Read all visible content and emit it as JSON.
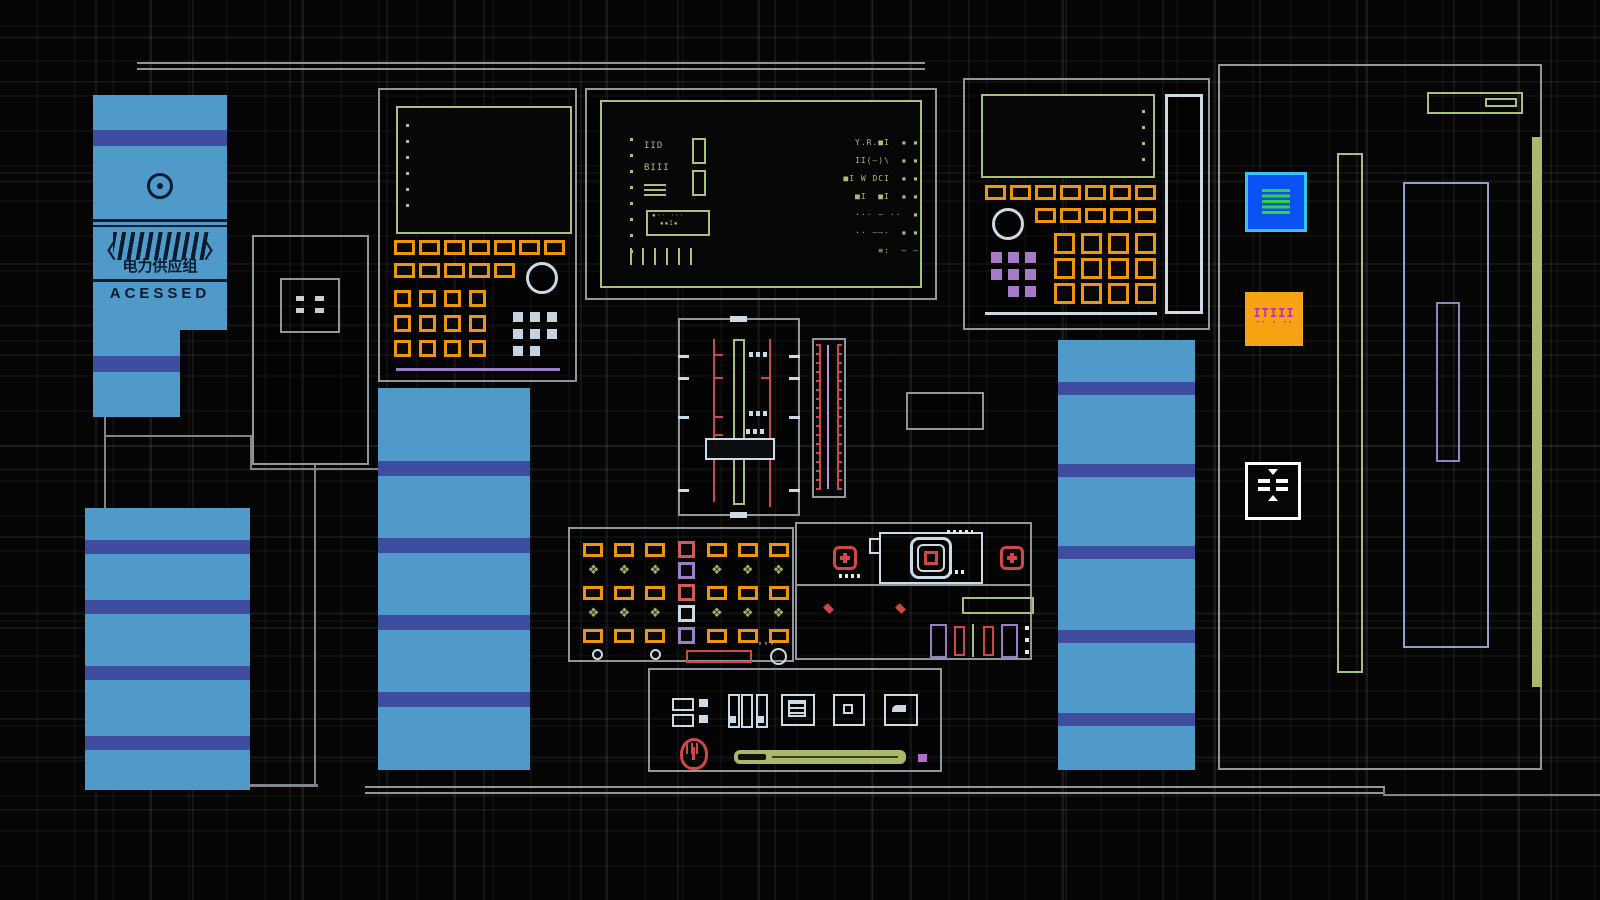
{
  "title": "power-grid-control-board",
  "colors": {
    "orange": "#ef940e",
    "screen_green": "#a9bf7a",
    "panel_blue": "#4f9ac9",
    "stripe_indigo": "#3f4da0",
    "alert_red": "#cf4747",
    "steel": "#ccdae6",
    "lavender": "#9b7fc4",
    "periwinkle": "#8fa0cc",
    "sage": "#a9b86a",
    "bright_blue": "#0b52f5",
    "cyan_border": "#35c5f2",
    "item_orange": "#f6a313",
    "magenta": "#cc22cc"
  },
  "power_unit": {
    "bracket_left": "〈",
    "bracket_right": "〉",
    "label_cn": "电力供应组",
    "status": "ACESSED"
  },
  "main_screen": {
    "left_line_1": "IID",
    "left_line_2": "BIII",
    "meter_line_1": "▪·· ···",
    "meter_line_2": "▪▪I▪",
    "right_lines": [
      "Y.R.■I  ▪ ▪",
      "II(–)\\  ▪ ▪",
      "■I W DCI  ▪ ▪",
      "■I  ■I  ▪ ▪",
      "··· – ··  ▪",
      "·· ––·  ▪ ▪",
      "≡:  – –"
    ]
  },
  "rack": {
    "item_button_line1": "ITIII",
    "item_button_line2": "·· · ··"
  },
  "icons": {
    "diamond": "❖",
    "quotes": "'''"
  }
}
